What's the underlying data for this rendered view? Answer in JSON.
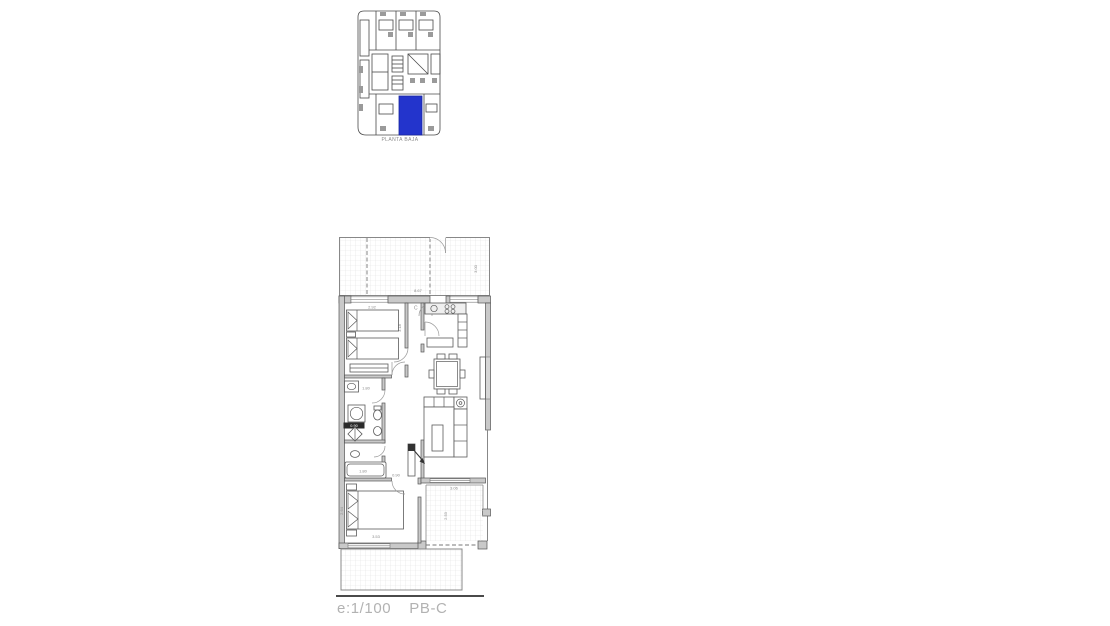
{
  "colors": {
    "highlight_blue": "#2334cc",
    "wall_fill": "#c9c9c9",
    "dim_text": "#8a8a8a",
    "footer_text": "#b2b2b2"
  },
  "site_plan": {
    "label": "PLANTA BAJA"
  },
  "floor_plan": {
    "unit_label": "C",
    "dims": {
      "terrace_width": "8.67",
      "terrace_depth": "3.00",
      "bed1_width": "2.92",
      "hall_depth": "3.18",
      "bath_counter": "1.80",
      "utility_width": "0.90",
      "bathtub_length": "1.80",
      "hall_width": "0.90",
      "bed2_width": "3.53",
      "bed2_depth": "2.64",
      "patio_width": "3.06",
      "patio_depth": "2.53"
    }
  },
  "footer": {
    "scale": "e:1/100",
    "plan_code": "PB-C"
  }
}
